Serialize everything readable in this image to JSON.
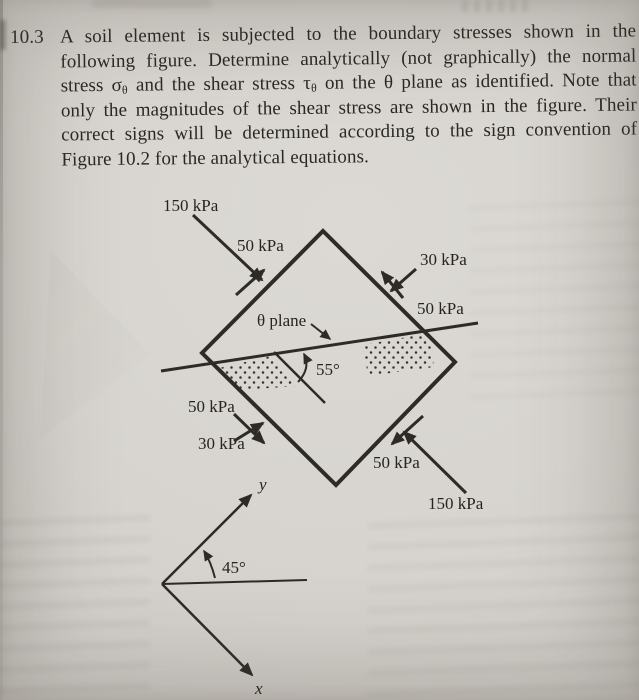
{
  "problem": {
    "number": "10.3",
    "line1": "A soil element is subjected to the boundary stresses shown in the",
    "line2": "following figure. Determine analytically (not graphically) the normal",
    "line3_a": "stress σ",
    "line3_sub1": "θ",
    "line3_b": " and the shear stress τ",
    "line3_sub2": "θ",
    "line3_c": " on the θ plane as identified. Note that",
    "line4": "only the magnitudes of the shear stress are shown in the figure. Their",
    "line5": "correct signs will be determined according to the sign convention of",
    "line6": "Figure 10.2 for the analytical equations."
  },
  "figure": {
    "top_left_face": {
      "normal": "150 kPa",
      "shear": "50 kPa"
    },
    "top_right_face": {
      "normal": "30 kPa",
      "shear": "50 kPa"
    },
    "bottom_left_face": {
      "normal": "30 kPa",
      "shear": "50 kPa"
    },
    "bottom_right_face": {
      "normal": "150 kPa",
      "shear": "50 kPa"
    },
    "theta_plane_label": "θ plane",
    "theta_angle_label": "55°",
    "axes": {
      "angle_label": "45°",
      "x_label": "x",
      "y_label": "y"
    }
  },
  "colors": {
    "page_background": "#d7d4cf",
    "ink": "#2e2b27"
  }
}
